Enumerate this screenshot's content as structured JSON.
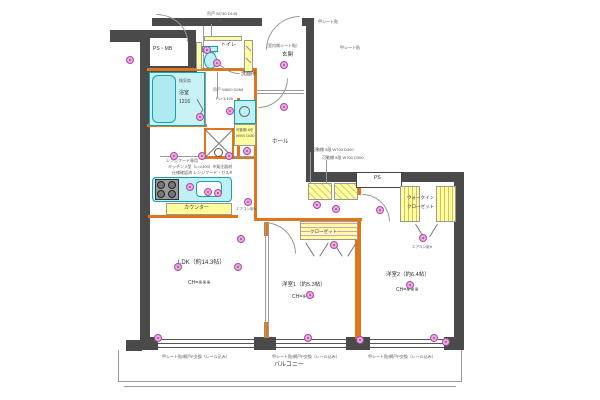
{
  "rooms": {
    "ps_mb": "PS・MB",
    "bathroom_vent": "換気扇",
    "bathroom": "浴室",
    "bathroom_size": "1216",
    "toilet": "トイレ",
    "entrance": "玄関",
    "entrance_note": "（室内側シート貼）",
    "washroom": "洗面所",
    "hall": "ホール",
    "ldk": "LDK（約14.3帖）",
    "ldk_ch": "CH=※※※",
    "bedroom1": "洋室1（約5.3帖）",
    "bedroom1_ch": "CH=※※※",
    "bedroom2": "洋室2（約6.4帖）",
    "bedroom2_ch": "CH=※※※",
    "closet": "クローゼット",
    "wic_line1": "ウォークイン",
    "wic_line2": "クローゼット",
    "ps": "PS",
    "counter": "カウンター",
    "balcony": "バルコニー"
  },
  "notes": {
    "top_hanging": "吊戸 W740 D145",
    "top_sheet": "甲シート貼",
    "top_right_sheet": "甲シート貼",
    "entrance_inner": "（室内側シート貼）",
    "shelf_note1": "可動棚 5段 W700 D300",
    "shelf_note2": "可動棚 5段 W700 D300",
    "wash_hanging": "吊戸 W600 D265",
    "wash_fl": "FL+1/100",
    "kitchen_note1": "レンジフード専用",
    "kitchen_note2": "キッチン 2型（L=2400）※発注器材",
    "kitchen_note3": "仕様確認済 レンジフード・ガス※",
    "storage_note1": "可動棚 4段",
    "storage_note2": "W900 D450",
    "window_note": "甲シート貼/網戸P交換（レール込み）",
    "aircon_note": "エアコン用※"
  },
  "colors": {
    "wall": "#4a4a4a",
    "renovation_orange": "#e0761c",
    "fixture_cyan": "#bff0f4",
    "storage_yellow": "#ffff9e",
    "symbol_magenta": "#eaaae2"
  }
}
